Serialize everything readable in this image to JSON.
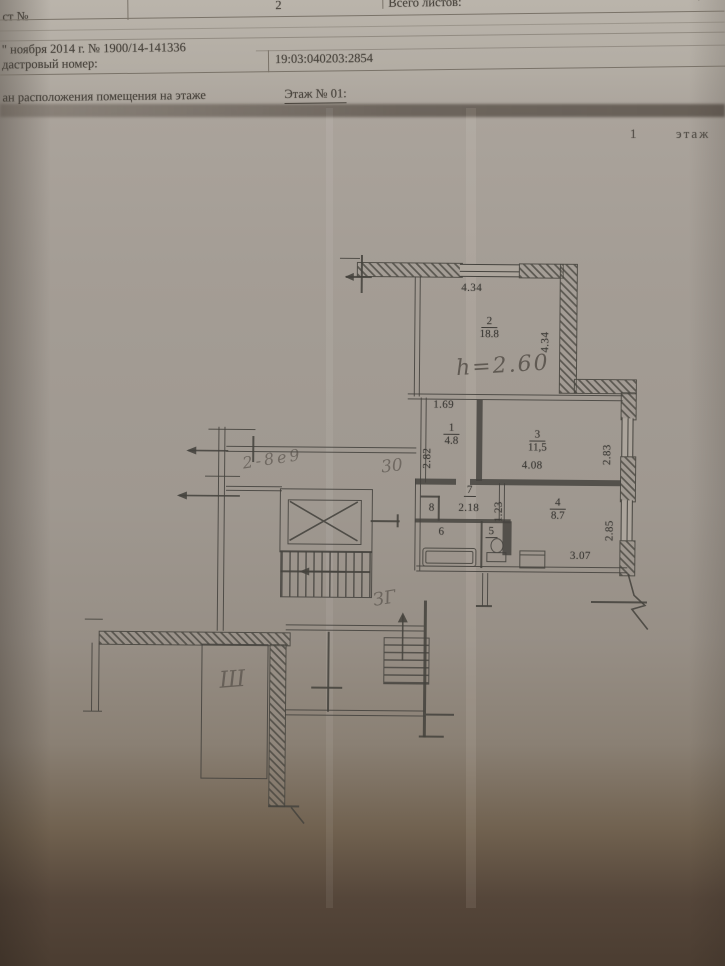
{
  "table": {
    "sheet_label": "ст №",
    "sheet_value": "2",
    "total_label": "Всего листов:",
    "date_line": "\" ноября 2014 г. № 1900/14-141336",
    "cadastral_label": "дастровый номер:",
    "cadastral_value": "19:03:040203:2854",
    "caption": "ан расположения помещения на этаже",
    "floor_ref": "Этаж № 01:"
  },
  "floor_note": {
    "num": "1",
    "word": "этаж"
  },
  "plan": {
    "rooms": {
      "room1": {
        "num": "1",
        "area": "4.8"
      },
      "room2": {
        "num": "2",
        "area": "18.8"
      },
      "room3": {
        "num": "3",
        "area": "11,5"
      },
      "room4": {
        "num": "4",
        "area": "8.7"
      },
      "room5": {
        "num": "5"
      },
      "room6": {
        "num": "6"
      },
      "room7": {
        "num": "7"
      },
      "room8": {
        "num": "8"
      }
    },
    "dims": {
      "top_width": "4.34",
      "right_height": "4.34",
      "hall_top": "1.69",
      "hall_left": "2.82",
      "room3_bottom": "4.08",
      "room3_window": "2.83",
      "corridor_width": "2.18",
      "corridor_height": "1.23",
      "kitchen_window": "2.85",
      "kitchen_bottom": "3.07"
    },
    "handwritten": {
      "ceiling_height": "h=2.60",
      "note_corridor": "2-8е9",
      "note_mid": "30",
      "note_lower": "ЗГ",
      "note_storage": "Ш"
    }
  }
}
